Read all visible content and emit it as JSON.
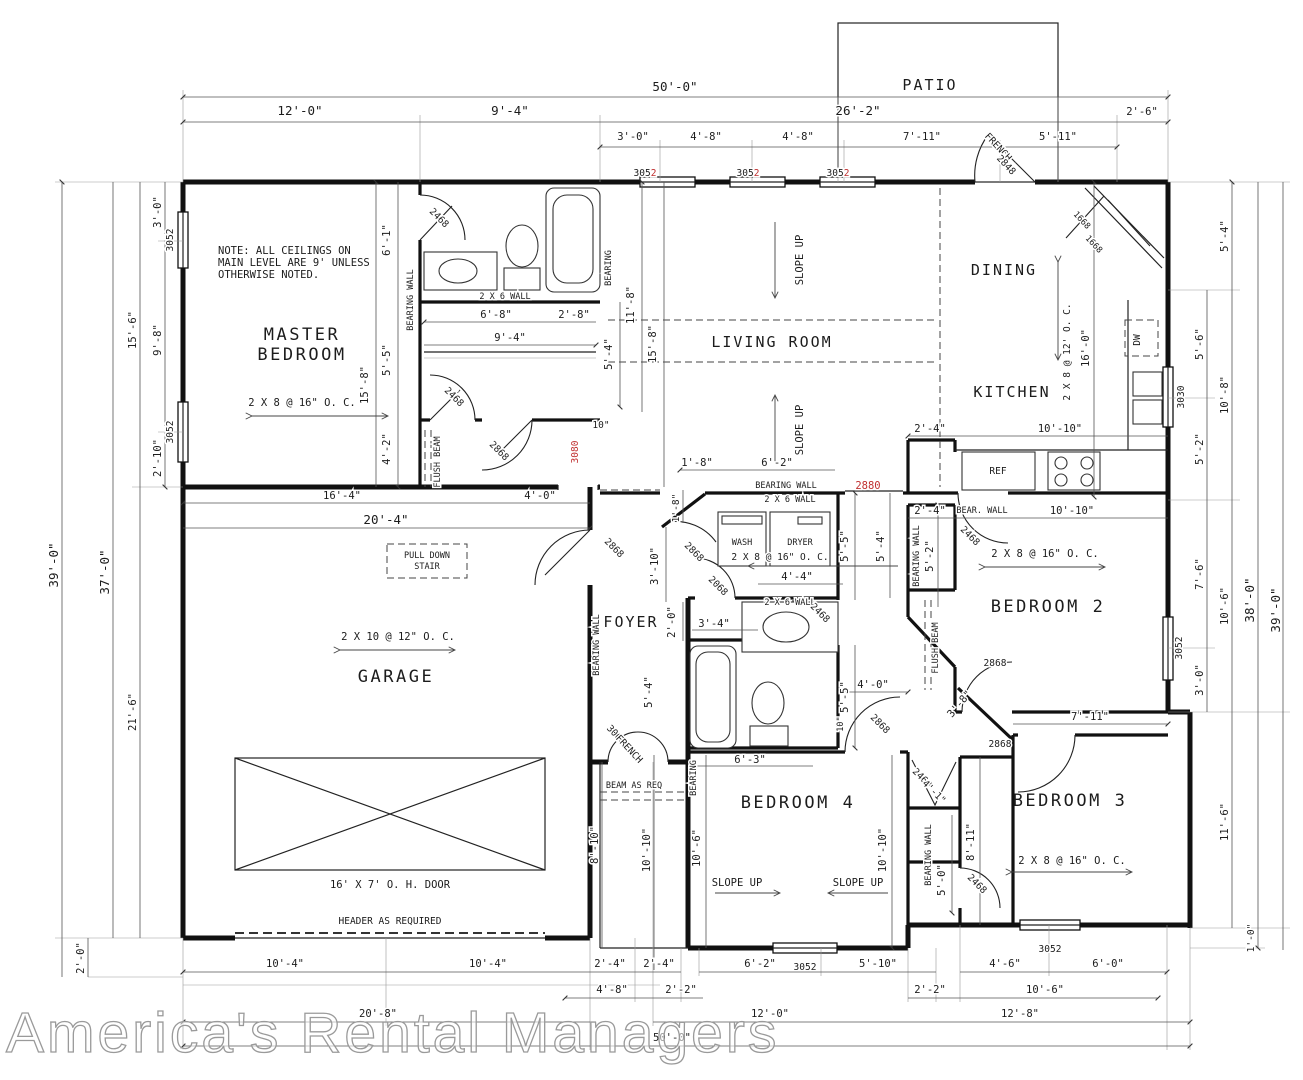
{
  "watermark": "America's Rental Managers",
  "colors": {
    "line": "#1c1c1c",
    "red": "#c03030"
  },
  "rooms": {
    "master_l1": "MASTER",
    "master_l2": "BEDROOM",
    "living": "LIVING ROOM",
    "dining": "DINING",
    "kitchen": "KITCHEN",
    "garage": "GARAGE",
    "foyer": "FOYER",
    "bedroom2": "BEDROOM 2",
    "bedroom3": "BEDROOM 3",
    "bedroom4": "BEDROOM 4",
    "patio": "PATIO"
  },
  "note": {
    "l1": "NOTE: ALL CEILINGS ON",
    "l2": "MAIN LEVEL ARE 9' UNLESS",
    "l3": "OTHERWISE NOTED."
  },
  "specs": {
    "joist_2x8_16": "2 X 8 @ 16\" O. C.",
    "joist_2x10_12": "2 X 10 @ 12\" O. C.",
    "joist_2x8_12": "2 X 8 @ 12' O. C.",
    "slope_up": "SLOPE UP",
    "pull_down_1": "PULL DOWN",
    "pull_down_2": "STAIR",
    "oh_door": "16' X 7' O. H. DOOR",
    "header": "HEADER AS REQUIRED",
    "beam_as_req": "BEAM AS REQ",
    "flush_beam": "FLUSH BEAM",
    "bearing_wall": "BEARING WALL",
    "bearing": "BEARING",
    "bear_wall": "BEAR. WALL",
    "wall_2x6": "2 X 6 WALL",
    "wash": "WASH",
    "dryer": "DRYER",
    "ref": "REF",
    "dw": "DW"
  },
  "tags": {
    "w3052": "3052",
    "w3052_a": "305",
    "w3052_b": "2",
    "w3030": "3030",
    "o3080": "3080",
    "o2880": "2880",
    "d2468": "2468",
    "d2868": "2868",
    "d2068": "2068",
    "d2848": "2848",
    "d3068": "3068",
    "d1668": "1668",
    "french": "FRENCH"
  },
  "dims": {
    "d50_0": "50'-0\"",
    "d12_0": "12'-0\"",
    "d9_4": "9'-4\"",
    "d26_2": "26'-2\"",
    "d2_6": "2'-6\"",
    "d3_0": "3'-0\"",
    "d4_8": "4'-8\"",
    "d7_11": "7'-11\"",
    "d5_11": "5'-11\"",
    "d39_0": "39'-0\"",
    "d37_0": "37'-0\"",
    "d15_6": "15'-6\"",
    "d9_8": "9'-8\"",
    "d2_10": "2'-10\"",
    "d21_6": "21'-6\"",
    "d2_0": "2'-0\"",
    "d5_4": "5'-4\"",
    "d5_6": "5'-6\"",
    "d10_8": "10'-8\"",
    "d5_2": "5'-2\"",
    "d7_6": "7'-6\"",
    "d10_6": "10'-6\"",
    "d38_0": "38'-0\"",
    "d11_6": "11'-6\"",
    "d1_0": "1'-0\"",
    "d6_1": "6'-1\"",
    "d15_8": "15'-8\"",
    "d5_5": "5'-5\"",
    "d4_2": "4'-2\"",
    "d6_8": "6'-8\"",
    "d2_8": "2'-8\"",
    "d10in": "10\"",
    "d11_8": "11'-8\"",
    "d16_4": "16'-4\"",
    "d4_0": "4'-0\"",
    "d20_4": "20'-4\"",
    "d2_4": "2'-4\"",
    "d10_10": "10'-10\"",
    "d1_8": "1'-8\"",
    "d6_2": "6'-2\"",
    "d3_10": "3'-10\"",
    "d3_4": "3'-4\"",
    "d4_4": "4'-4\"",
    "d2_2": "2'-2\"",
    "d5_10": "5'-10\"",
    "d4_6": "4'-6\"",
    "d6_0": "6'-0\"",
    "d20_8": "20'-8\"",
    "d12_8": "12'-8\"",
    "d16_0": "16'-0\"",
    "d10_4": "10'-4\"",
    "d6_3": "6'-3\"",
    "d5_0": "5'-0\"",
    "d8_11": "8'-11\"",
    "d3_8": "3'-8\"",
    "d4_1": "4'-1\"",
    "d8_10": "8'-10\""
  }
}
